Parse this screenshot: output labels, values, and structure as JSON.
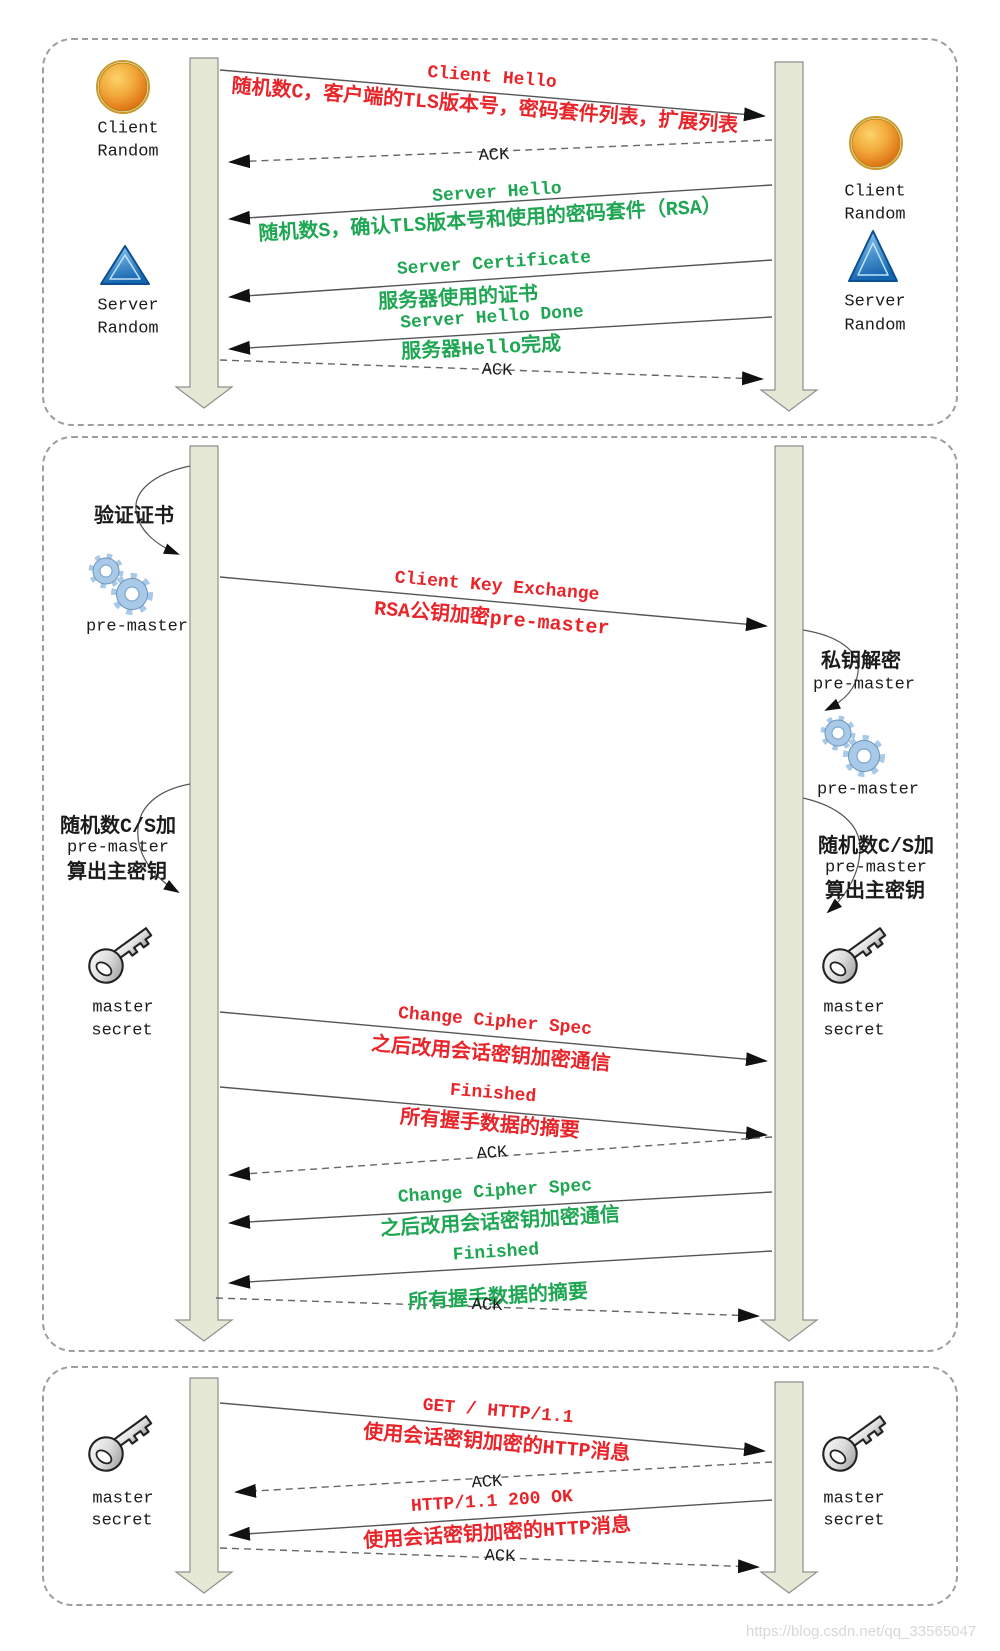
{
  "watermark": "https://blog.csdn.net/qq_33565047",
  "colors": {
    "client_msg": "#e8252a",
    "server_msg": "#1fa653",
    "lifeline_fill": "#e4e8d5"
  },
  "actors": {
    "client_random": {
      "line1": "Client",
      "line2": "Random"
    },
    "server_random": {
      "line1": "Server",
      "line2": "Random"
    },
    "master_secret": {
      "line1": "master",
      "line2": "secret"
    },
    "pre_master": "pre-master"
  },
  "phase1": {
    "client_hello": {
      "title": "Client Hello",
      "desc": "随机数C，客户端的TLS版本号，密码套件列表，扩展列表"
    },
    "ack1": "ACK",
    "server_hello": {
      "title": "Server Hello",
      "desc": "随机数S，确认TLS版本号和使用的密码套件（RSA）"
    },
    "server_certificate": {
      "title": "Server Certificate",
      "desc": "服务器使用的证书"
    },
    "server_hello_done": {
      "title": "Server Hello Done",
      "desc": "服务器Hello完成"
    },
    "ack2": "ACK"
  },
  "phase2": {
    "verify_cert": "验证证书",
    "client_key_exchange": {
      "title": "Client Key Exchange",
      "desc": "RSA公钥加密pre-master"
    },
    "decrypt": {
      "line1": "私钥解密",
      "line2": "pre-master"
    },
    "derive": {
      "line1": "随机数C/S加",
      "line2": "pre-master",
      "line3": "算出主密钥"
    },
    "change_cipher_spec_client": {
      "title": "Change Cipher Spec",
      "desc": "之后改用会话密钥加密通信"
    },
    "finished_client": {
      "title": "Finished",
      "desc": "所有握手数据的摘要"
    },
    "ack1": "ACK",
    "change_cipher_spec_server": {
      "title": "Change Cipher Spec",
      "desc": "之后改用会话密钥加密通信"
    },
    "finished_server": {
      "title": "Finished",
      "desc": "所有握手数据的摘要"
    },
    "ack2": "ACK"
  },
  "phase3": {
    "get_request": {
      "title": "GET / HTTP/1.1",
      "desc": "使用会话密钥加密的HTTP消息"
    },
    "ack1": "ACK",
    "response": {
      "title": "HTTP/1.1 200 OK",
      "desc": "使用会话密钥加密的HTTP消息"
    },
    "ack2": "ACK"
  }
}
